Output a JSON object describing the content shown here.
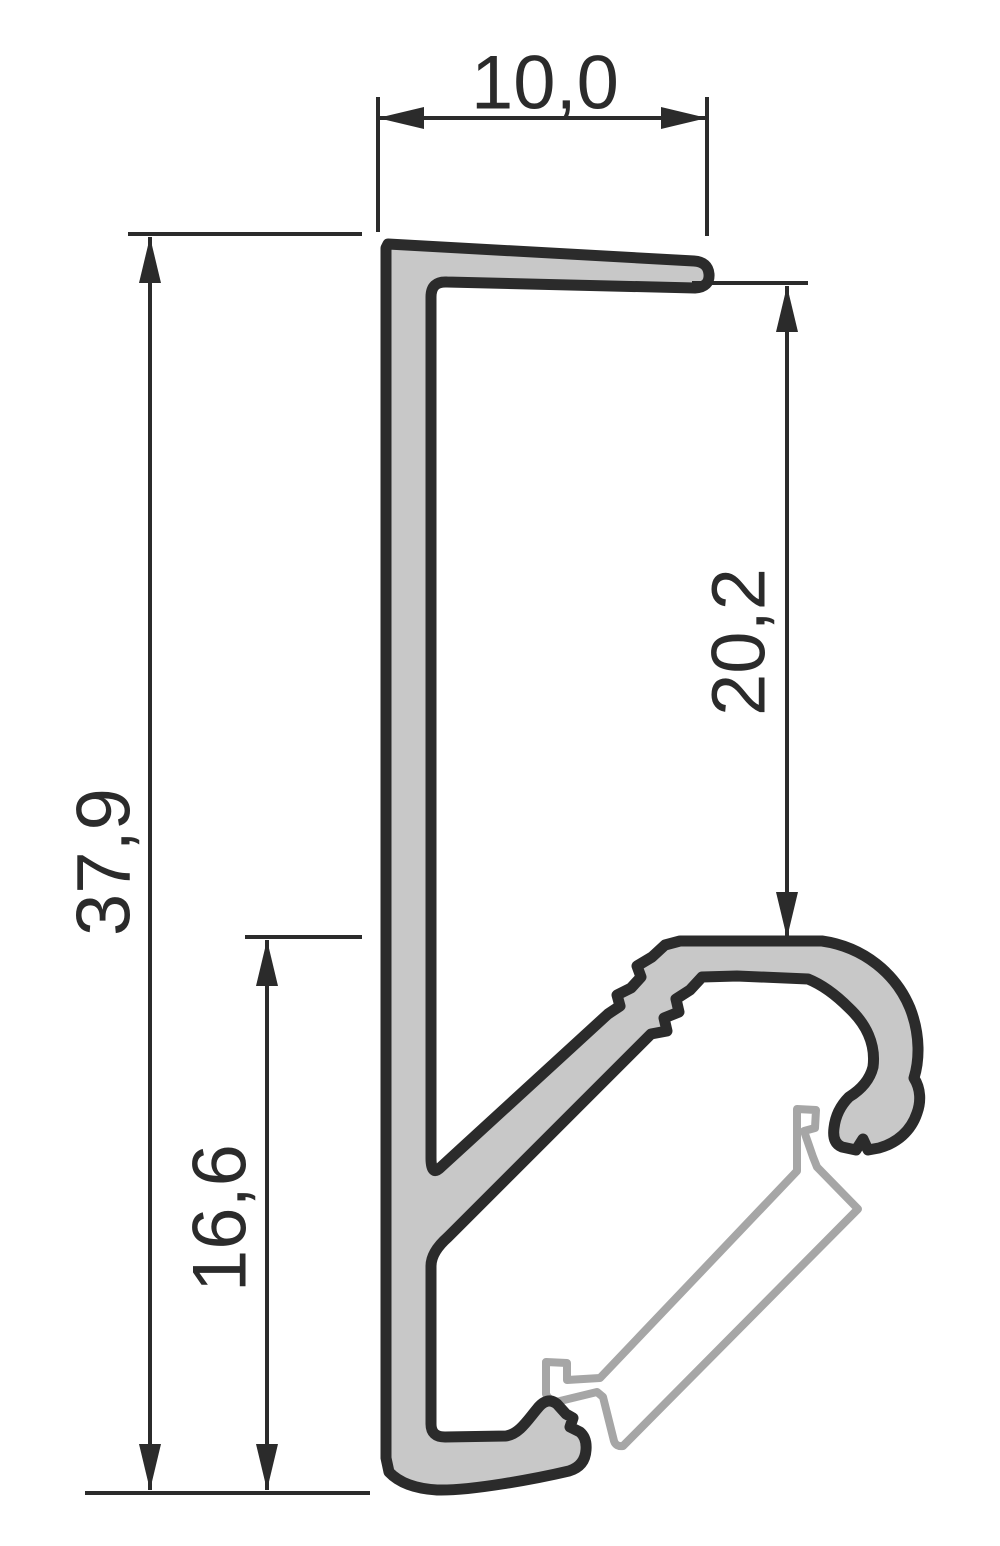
{
  "dimensions": {
    "top_width": "10,0",
    "overall_height": "37,9",
    "channel_drop": "20,2",
    "lower_height": "16,6"
  },
  "colors": {
    "background": "#ffffff",
    "profile_fill": "#c8c8c8",
    "profile_outline": "#2b2b2b",
    "diffuser_outline": "#a6a6a6",
    "diffuser_fill": "#ffffff",
    "dimension_lines": "#2b2b2b",
    "dimension_text": "#2b2b2b"
  }
}
